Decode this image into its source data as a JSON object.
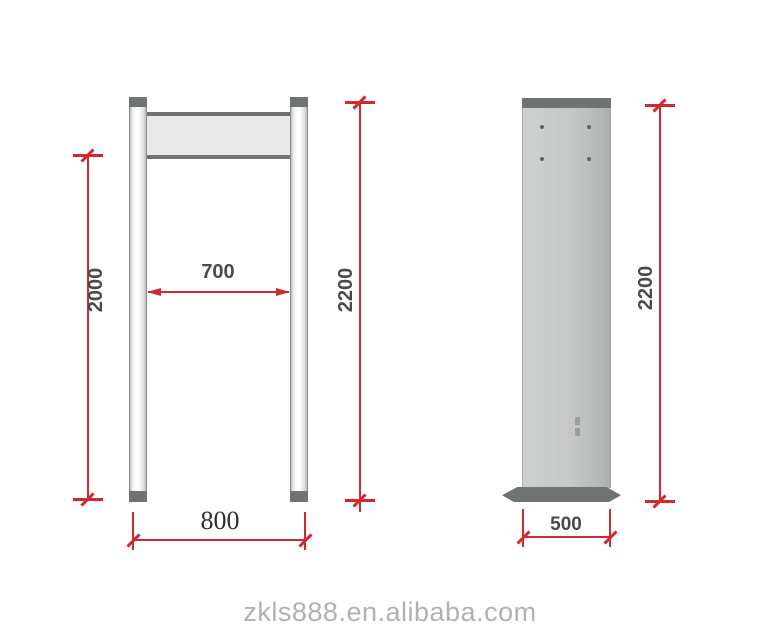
{
  "front_view": {
    "name": "walk-through gate front view",
    "labels": {
      "passage_height": "2000",
      "inner_width": "700",
      "total_height": "2200",
      "base_width": "800"
    }
  },
  "side_view": {
    "name": "detector column side view",
    "labels": {
      "total_height": "2200",
      "depth": "500"
    }
  },
  "watermark": {
    "text": "zkls888.en.alibaba.com"
  },
  "colors": {
    "dimension_red": "#cf2a30",
    "outline_gray": "#6f7374",
    "panel_gray": "#c6c8c7",
    "label_gray": "#4a4a4a",
    "watermark_gray": "#b1b1b1"
  }
}
